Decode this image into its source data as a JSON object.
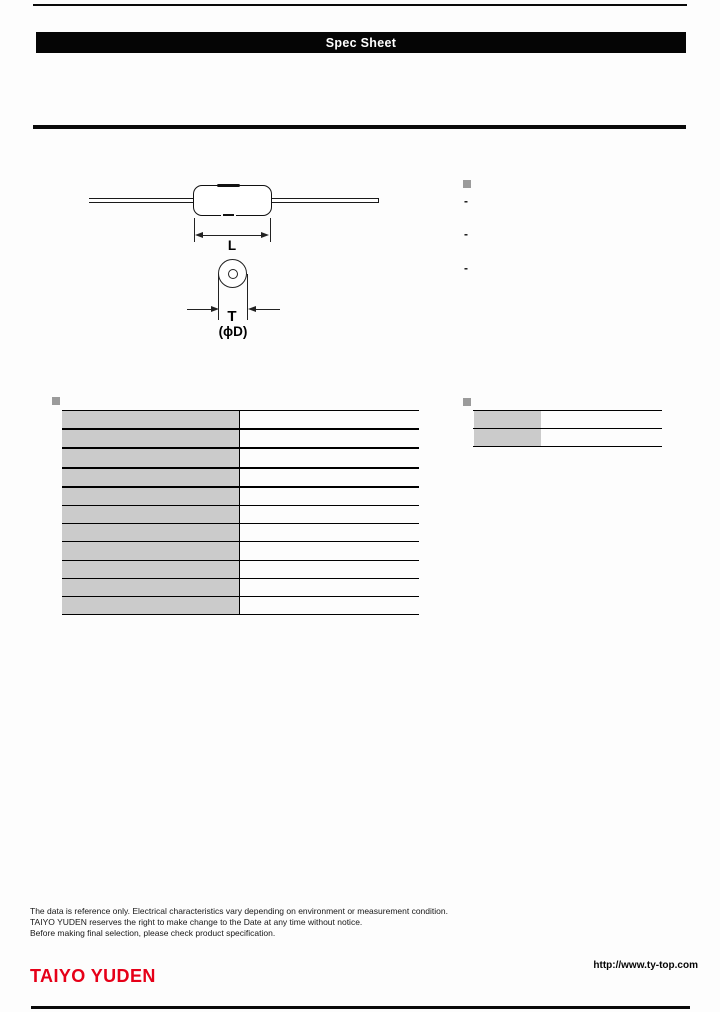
{
  "header": {
    "title": "Spec Sheet"
  },
  "diagram": {
    "dim_length_label": "L",
    "dim_thickness_label": "T",
    "dim_diameter_label": "(ϕD)"
  },
  "features": {
    "items": [
      "-",
      "-",
      "-"
    ]
  },
  "spec_table": {
    "rows": [
      {
        "label": "",
        "value": ""
      },
      {
        "label": "",
        "value": ""
      },
      {
        "label": "",
        "value": ""
      },
      {
        "label": "",
        "value": ""
      },
      {
        "label": "",
        "value": ""
      },
      {
        "label": "",
        "value": ""
      },
      {
        "label": "",
        "value": ""
      },
      {
        "label": "",
        "value": ""
      },
      {
        "label": "",
        "value": ""
      },
      {
        "label": "",
        "value": ""
      },
      {
        "label": "",
        "value": ""
      }
    ]
  },
  "info_table": {
    "rows": [
      {
        "label": "",
        "value": ""
      },
      {
        "label": "",
        "value": ""
      }
    ]
  },
  "footer": {
    "disclaimers": [
      "The data is reference only. Electrical characteristics vary depending on environment or measurement condition.",
      "TAIYO YUDEN reserves the right to make change to the Date at any time without notice.",
      "Before making final selection, please check product specification."
    ],
    "logo_text": "TAIYO YUDEN",
    "url": "http://www.ty-top.com"
  },
  "colors": {
    "accent_red": "#e60018",
    "cell_gray": "#cbcbcb",
    "bullet_gray": "#9b9b9b",
    "bar_black": "#050505"
  }
}
